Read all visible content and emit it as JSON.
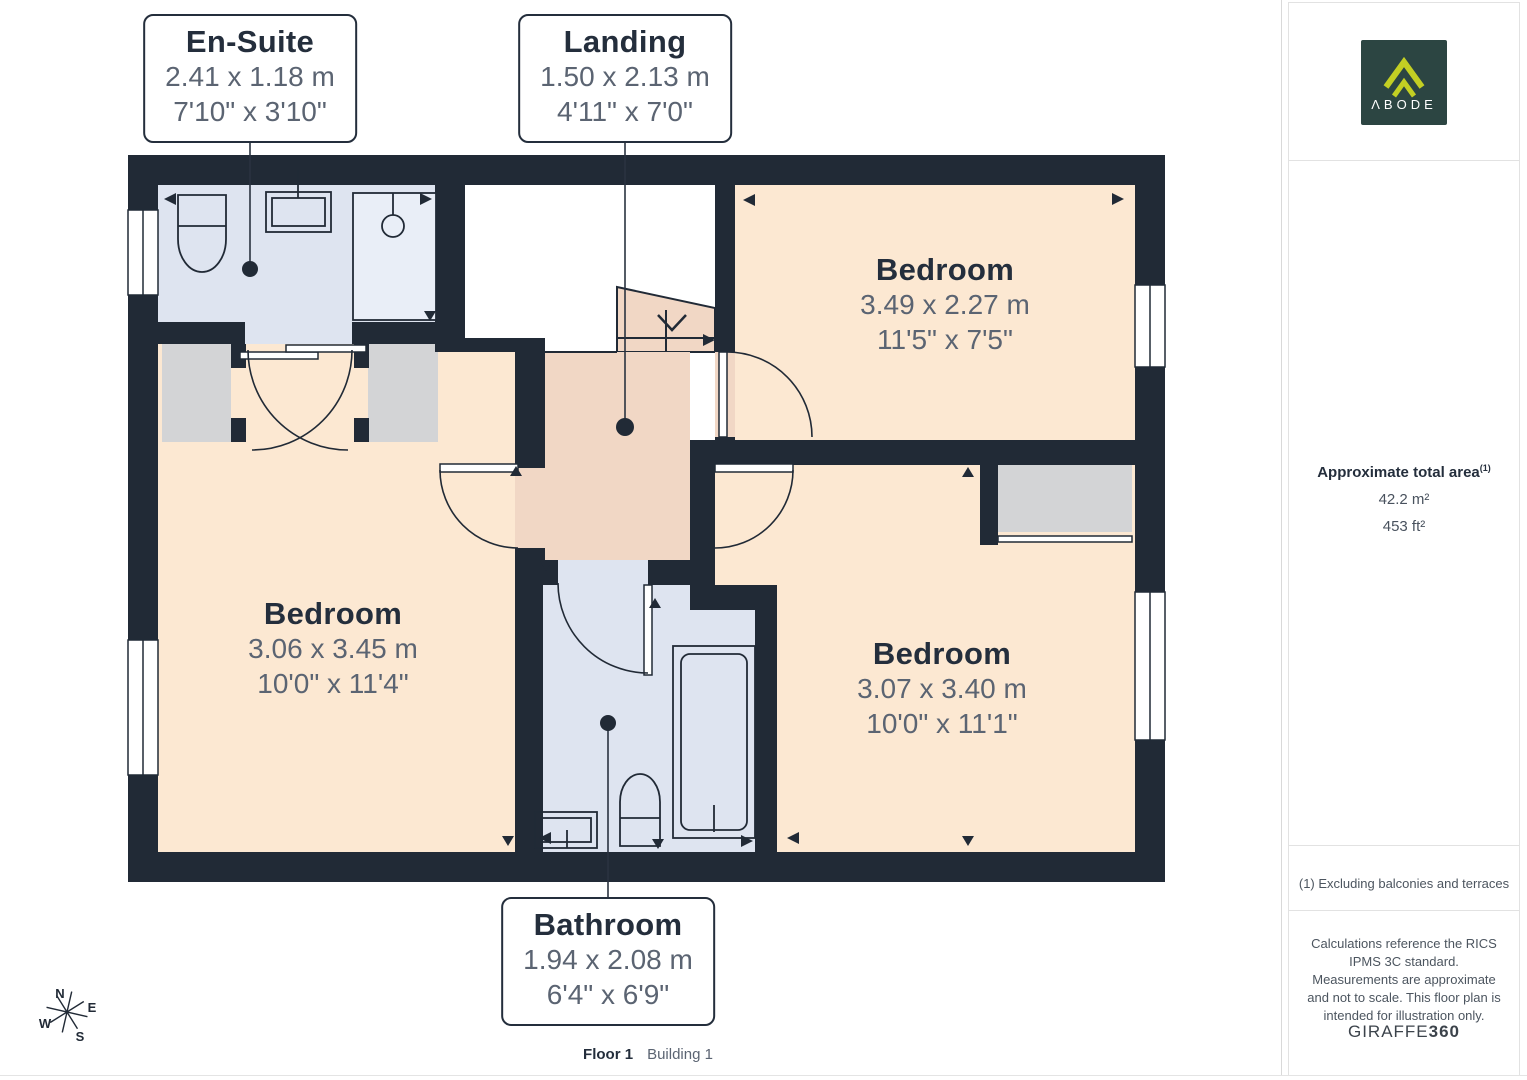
{
  "colors": {
    "wall": "#212a36",
    "bedroom_floor": "#fce8d2",
    "hall_floor": "#f1d7c5",
    "wet_room_floor": "#dee4f0",
    "closet": "#d3d4d6",
    "logo_background": "#2c4542",
    "logo_accent": "#c3cf23"
  },
  "rooms": {
    "ensuite": {
      "title": "En-Suite",
      "metric": "2.41 x 1.18 m",
      "imperial": "7'10\" x 3'10\""
    },
    "landing": {
      "title": "Landing",
      "metric": "1.50 x 2.13 m",
      "imperial": "4'11\" x 7'0\""
    },
    "bathroom": {
      "title": "Bathroom",
      "metric": "1.94 x 2.08 m",
      "imperial": "6'4\" x 6'9\""
    },
    "bedroom_top_right": {
      "title": "Bedroom",
      "metric": "3.49 x 2.27 m",
      "imperial": "11'5\" x 7'5\""
    },
    "bedroom_left": {
      "title": "Bedroom",
      "metric": "3.06 x 3.45 m",
      "imperial": "10'0\" x 11'4\""
    },
    "bedroom_bottom_right": {
      "title": "Bedroom",
      "metric": "3.07 x 3.40 m",
      "imperial": "10'0\" x 11'1\""
    }
  },
  "compass": {
    "north": "N",
    "east": "E",
    "south": "S",
    "west": "W"
  },
  "footer": {
    "floor": "Floor 1",
    "building": "Building 1"
  },
  "sidebar": {
    "logo_text": "ΛBODE",
    "area_heading": "Approximate total area",
    "area_footnote_marker": "(1)",
    "area_metric": "42.2 m²",
    "area_imperial": "453 ft²",
    "footnote": "(1) Excluding balconies and terraces",
    "disclaimer": "Calculations reference the RICS IPMS 3C standard. Measurements are approximate and not to scale. This floor plan is intended for illustration only.",
    "brand_word": "GIRAFFE",
    "brand_number": "360"
  }
}
